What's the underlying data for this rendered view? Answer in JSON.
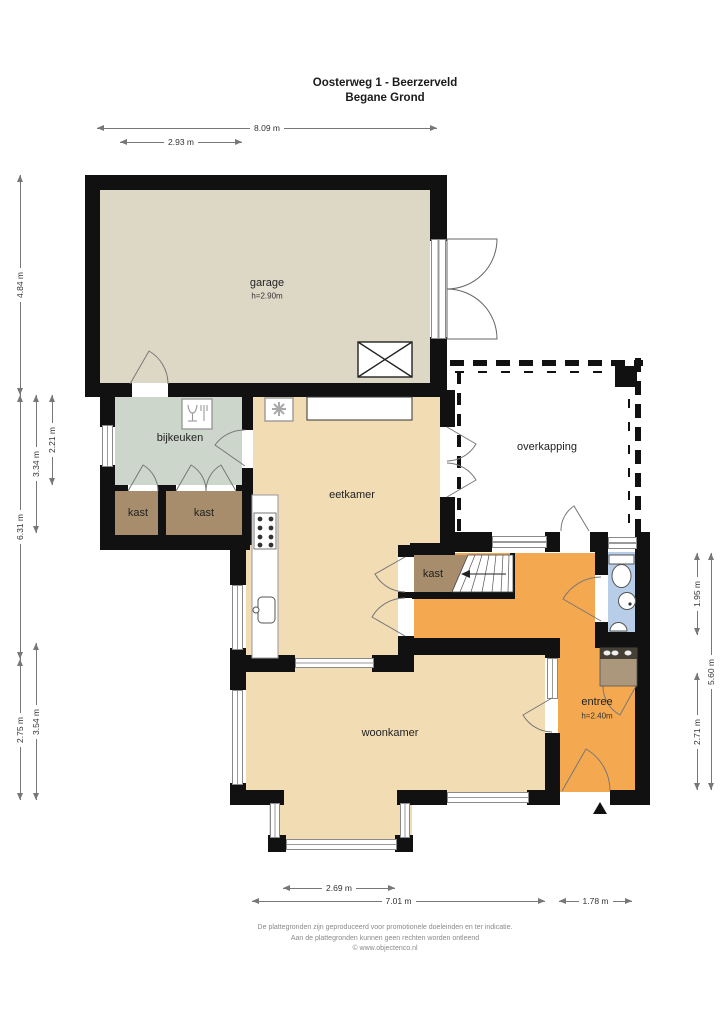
{
  "title": {
    "line1": "Oosterweg 1 - Beerzerveld",
    "line2": "Begane Grond"
  },
  "rooms": {
    "garage": {
      "name": "garage",
      "height": "h=2.90m"
    },
    "bijkeuken": {
      "name": "bijkeuken"
    },
    "kast_left": {
      "name": "kast"
    },
    "kast_middle": {
      "name": "kast"
    },
    "eetkamer": {
      "name": "eetkamer"
    },
    "overkapping": {
      "name": "overkapping"
    },
    "kast_hal": {
      "name": "kast"
    },
    "entree": {
      "name": "entree",
      "height": "h=2.40m"
    },
    "woonkamer": {
      "name": "woonkamer"
    }
  },
  "dimensions": {
    "top_total": "8.09 m",
    "top_left": "2.93 m",
    "left_garage": "4.84 m",
    "left_middle": "6.31 m",
    "left_inner_top": "3.34 m",
    "left_innermost": "2.21 m",
    "left_bottom": "2.75 m",
    "left_inner_bottom": "3.54 m",
    "right_toilet": "1.95 m",
    "right_total": "5.60 m",
    "right_entree": "2.71 m",
    "bottom_bay": "2.69 m",
    "bottom_total": "7.01 m",
    "bottom_entree": "1.78 m"
  },
  "footer": {
    "line1": "De plattegronden zijn geproduceerd voor promotionele doeleinden en ter indicatie.",
    "line2": "Aan de plattegronden kunnen geen rechten worden ontleend",
    "line3": "© www.objectenco.nl"
  },
  "icons": {
    "dishwasher": "dishwasher-icon",
    "ventilation": "ventilation-unit-icon",
    "stove": "stove-icon",
    "kitchen_sink": "kitchen-sink-icon",
    "toilet": "toilet-icon",
    "washbasin": "washbasin-icon",
    "small_sink": "small-sink-icon",
    "skylight": "skylight-marker-icon",
    "stairs": "staircase",
    "entrance": "entrance-arrow-icon"
  },
  "colors": {
    "wall": "#111111",
    "garage": "#ddd8c6",
    "bijkeuken": "#ccd6cb",
    "kast": "#a78d6c",
    "living": "#f2dcb3",
    "entree": "#f4a950",
    "bathroom": "#b7cde8",
    "cabinet": "#ab977b",
    "overkapping": "#ffffff"
  }
}
